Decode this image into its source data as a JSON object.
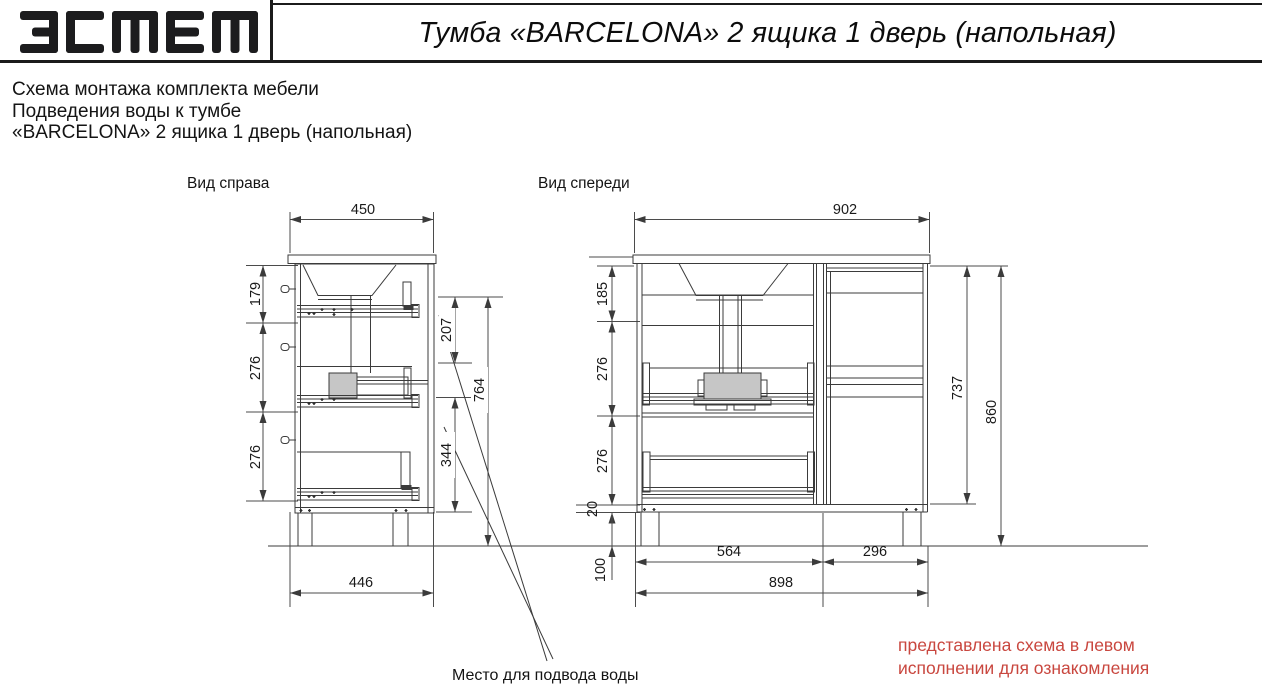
{
  "header": {
    "brand": "эстет",
    "title": "Тумба «BARCELONA» 2 ящика 1 дверь (напольная)"
  },
  "description": {
    "line1": "Схема монтажа комплекта мебели",
    "line2": "Подведения воды к тумбе",
    "line3": "«BARCELONA» 2 ящика 1 дверь (напольная)"
  },
  "views": {
    "right": {
      "label": "Вид справа",
      "dims": {
        "top_width": "450",
        "upper_drawer": "179",
        "middle_drawer": "276",
        "lower_drawer": "276",
        "sink_zone_depth": "207",
        "lower_zone": "344",
        "inner_height": "764",
        "bottom_width": "446"
      }
    },
    "front": {
      "label": "Вид спереди",
      "dims": {
        "top_width": "902",
        "upper_section": "185",
        "middle_drawer": "276",
        "lower_drawer": "276",
        "bottom_panel": "20",
        "legs": "100",
        "drawers_width": "564",
        "door_width": "296",
        "base_width": "898",
        "carcass_height": "737",
        "total_height": "860"
      }
    }
  },
  "notes": {
    "water": "Место для подвода воды",
    "disclaimer1": "представлена схема в левом",
    "disclaimer2": "исполнении для ознакомления"
  },
  "colors": {
    "accent_red": "#c9473f",
    "line": "#3b3b3b",
    "siphon_fill": "#c6c6c6"
  }
}
